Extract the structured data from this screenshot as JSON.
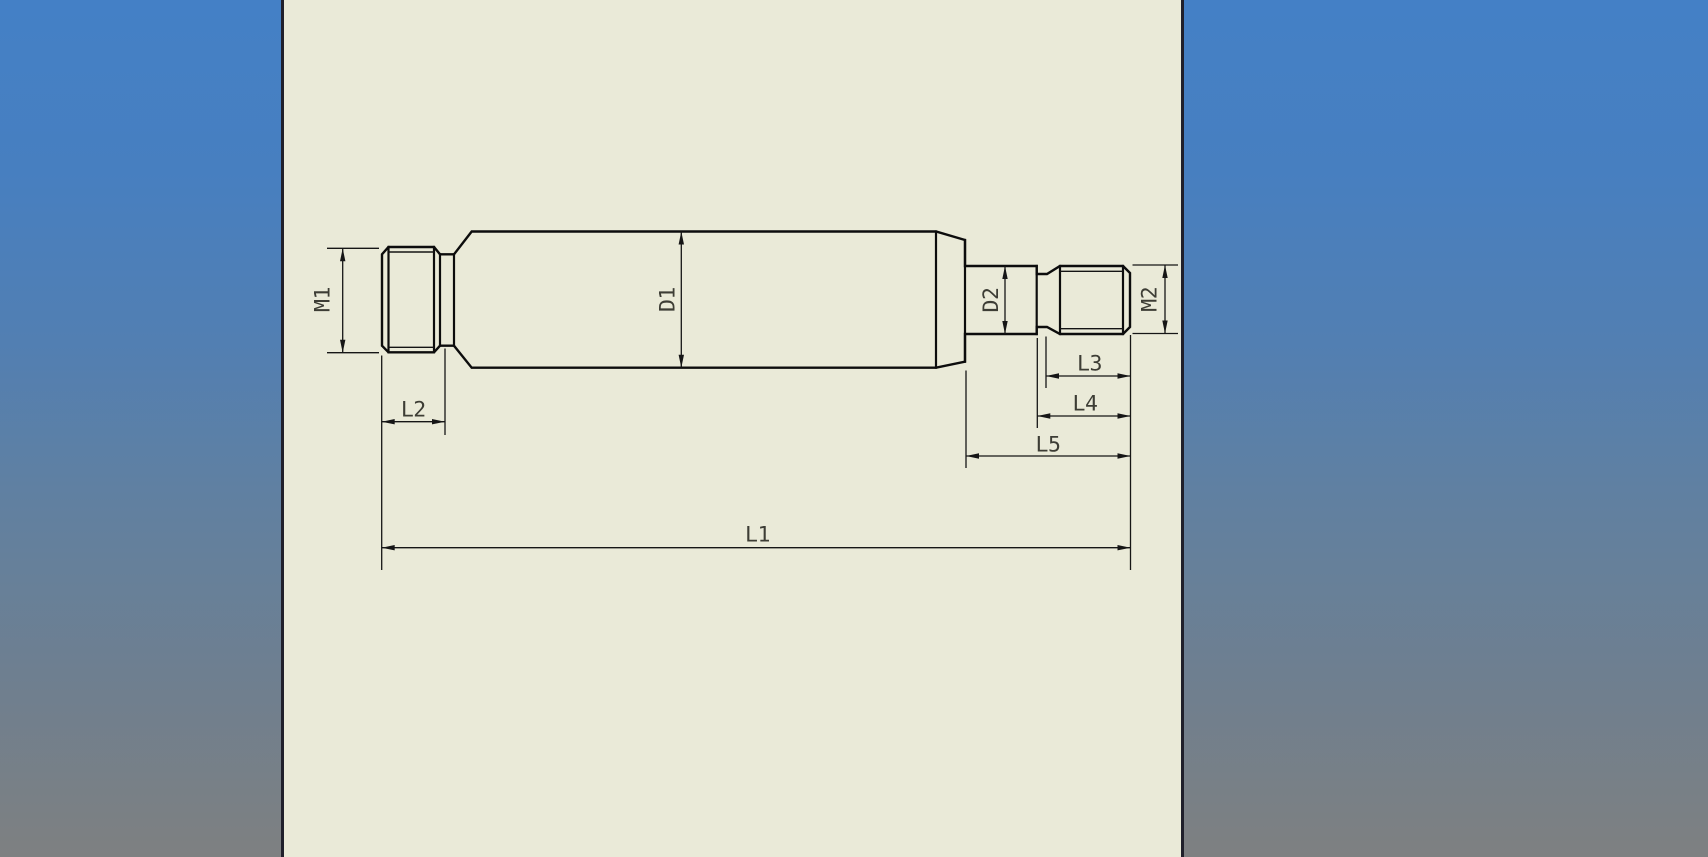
{
  "viewport": {
    "background_top_color": "#4480c6",
    "background_bottom_color": "#7e8081",
    "sheet_color": "#eaead8",
    "sheet_border_color": "#20202b",
    "line_color": "#0d0d0d",
    "dimension_text_color": "#3d3d35"
  },
  "drawing": {
    "dimensions": {
      "m1": "M1",
      "d1": "D1",
      "d2": "D2",
      "m2": "M2",
      "l1": "L1",
      "l2": "L2",
      "l3": "L3",
      "l4": "L4",
      "l5": "L5"
    }
  }
}
